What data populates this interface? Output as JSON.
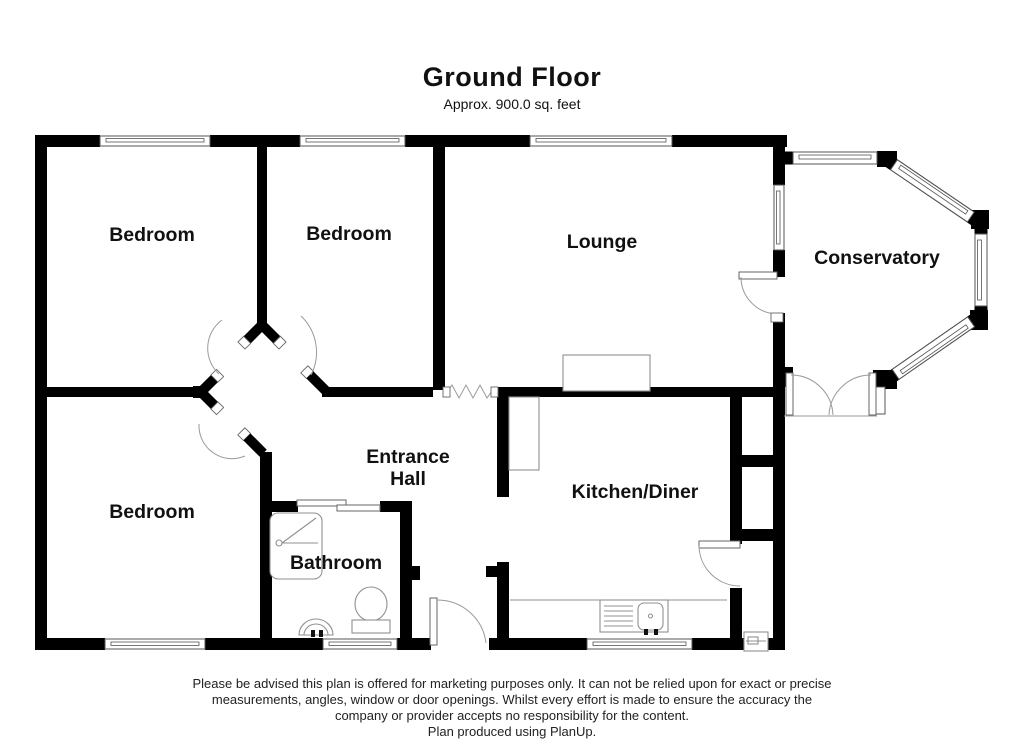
{
  "header": {
    "title": "Ground Floor",
    "subtitle": "Approx. 900.0 sq. feet"
  },
  "rooms": {
    "bedroom_top_left": {
      "label": "Bedroom"
    },
    "bedroom_top_middle": {
      "label": "Bedroom"
    },
    "bedroom_bottom_left": {
      "label": "Bedroom"
    },
    "lounge": {
      "label": "Lounge"
    },
    "conservatory": {
      "label": "Conservatory"
    },
    "entrance_hall": {
      "line1": "Entrance",
      "line2": "Hall"
    },
    "bathroom": {
      "label": "Bathroom"
    },
    "kitchen_diner": {
      "label": "Kitchen/Diner"
    }
  },
  "footer": {
    "disclaimer": [
      "Please be advised this plan is offered for marketing purposes only. It can not be relied upon for exact or precise",
      "measurements, angles, window or door openings. Whilst every effort is made to ensure the accuracy the",
      "company or provider accepts no responsibility for the content."
    ],
    "credit": "Plan produced using PlanUp."
  },
  "colors": {
    "wall": "#000000",
    "window_outline": "#555555",
    "door_arc": "#9a9a9a",
    "fixture": "#909090",
    "text": "#111111"
  }
}
